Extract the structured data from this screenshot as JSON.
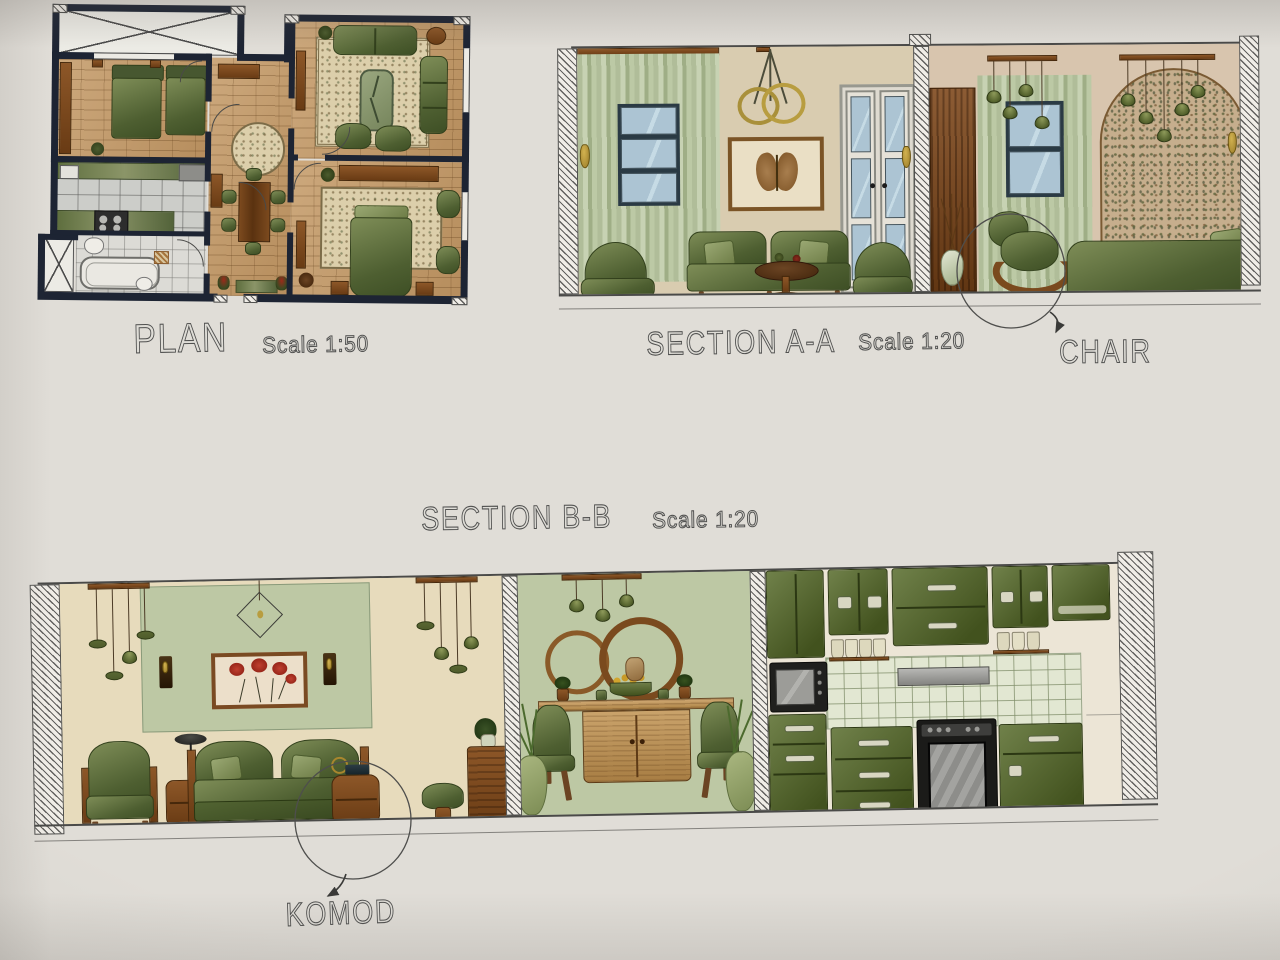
{
  "board": {
    "drawings": [
      {
        "id": "plan",
        "title": "PLAN",
        "scale": "Scale 1:50"
      },
      {
        "id": "section-aa",
        "title": "SECTION A-A",
        "scale": "Scale 1:20"
      },
      {
        "id": "section-bb",
        "title": "SECTION B-B",
        "scale": "Scale 1:20"
      }
    ],
    "callouts": [
      {
        "label": "CHAIR",
        "target": "rocking-chair"
      },
      {
        "label": "KOMOD",
        "target": "bedside-chest"
      }
    ]
  },
  "colors": {
    "paper": "#e0ddd7",
    "wall": "#1d2433",
    "wood": "#c49a67",
    "rug": "#dccfab",
    "green_furniture": "#5d6e3b",
    "green_wall": "#bdc8a4",
    "sage_curtain": "#b4c19d",
    "beige_wall": "#d9ccb0",
    "blush_wall": "#d8c5ae",
    "cream_wall": "#e7dbbc",
    "brown_wood": "#7c4518",
    "window_glass": "#acc4d3",
    "kitchen_cabinet": "#5a6b35",
    "gold_accent": "#b3943c",
    "red_flowers": "#a8281e",
    "ink": "#515150"
  }
}
